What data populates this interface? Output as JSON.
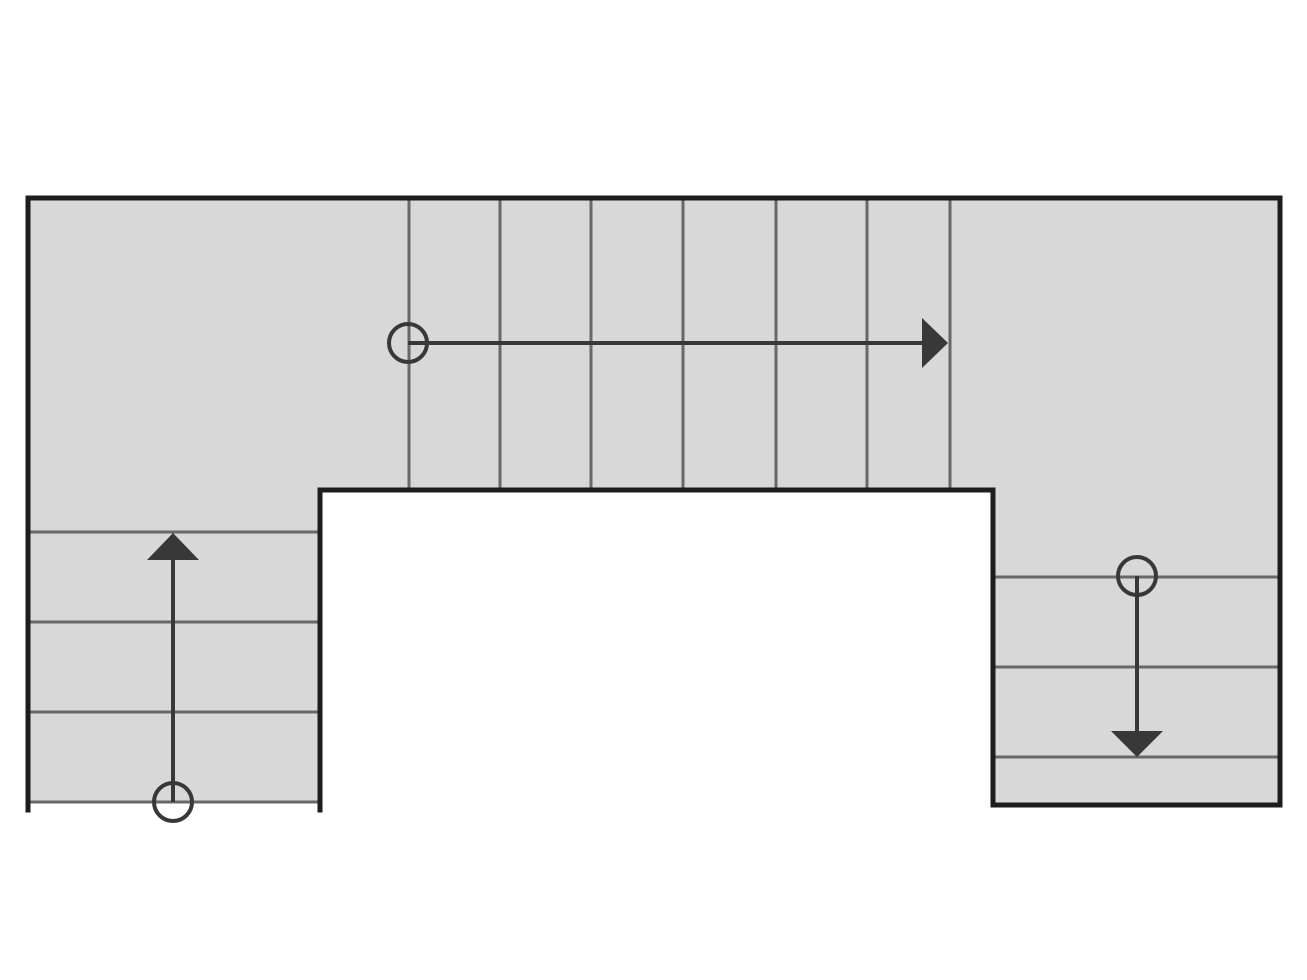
{
  "diagram": {
    "type": "stair-plan",
    "description": "U-shaped staircase floor plan with three flights and walk-line arrows",
    "canvas": {
      "width": 1307,
      "height": 980
    },
    "colors": {
      "background": "#ffffff",
      "tread_fill": "#d8d8d8",
      "outline": "#1d1d1d",
      "step_line": "#686868",
      "walk_line": "#383838"
    },
    "stroke_widths": {
      "outline": 5,
      "step_line": 3,
      "walk_line": 4,
      "circle": 4
    },
    "fill_region": {
      "points": [
        [
          28,
          198
        ],
        [
          1280,
          198
        ],
        [
          1280,
          805
        ],
        [
          993,
          805
        ],
        [
          993,
          490
        ],
        [
          320,
          490
        ],
        [
          320,
          802
        ],
        [
          28,
          802
        ]
      ]
    },
    "outline_path": {
      "points": [
        [
          28,
          810
        ],
        [
          28,
          198
        ],
        [
          1280,
          198
        ],
        [
          1280,
          805
        ],
        [
          993,
          805
        ],
        [
          993,
          490
        ],
        [
          320,
          490
        ],
        [
          320,
          810
        ]
      ]
    },
    "flights": [
      {
        "name": "upper-flight",
        "direction": "right",
        "step_lines": [
          [
            409,
            198,
            409,
            490
          ],
          [
            500,
            198,
            500,
            490
          ],
          [
            591,
            198,
            591,
            490
          ],
          [
            683,
            198,
            683,
            490
          ],
          [
            776,
            198,
            776,
            490
          ],
          [
            867,
            198,
            867,
            490
          ],
          [
            950,
            198,
            950,
            490
          ]
        ]
      },
      {
        "name": "left-flight",
        "direction": "up",
        "step_lines": [
          [
            28,
            532,
            320,
            532
          ],
          [
            28,
            622,
            320,
            622
          ],
          [
            28,
            712,
            320,
            712
          ],
          [
            28,
            802,
            320,
            802
          ]
        ]
      },
      {
        "name": "right-flight",
        "direction": "down",
        "step_lines": [
          [
            993,
            577,
            1280,
            577
          ],
          [
            993,
            667,
            1280,
            667
          ],
          [
            993,
            757,
            1280,
            757
          ]
        ]
      }
    ],
    "walk_lines": [
      {
        "name": "upper-walk-line",
        "start_circle": {
          "cx": 408,
          "cy": 343,
          "r": 19
        },
        "line": [
          408,
          343,
          924,
          343
        ],
        "arrowhead": [
          [
            922,
            318
          ],
          [
            922,
            368
          ],
          [
            948,
            343
          ]
        ]
      },
      {
        "name": "left-walk-line",
        "start_circle": {
          "cx": 173,
          "cy": 802,
          "r": 19
        },
        "line": [
          173,
          802,
          173,
          558
        ],
        "arrowhead": [
          [
            147,
            560
          ],
          [
            199,
            560
          ],
          [
            173,
            533
          ]
        ]
      },
      {
        "name": "right-walk-line",
        "start_circle": {
          "cx": 1137,
          "cy": 576,
          "r": 19
        },
        "line": [
          1137,
          576,
          1137,
          733
        ],
        "arrowhead": [
          [
            1111,
            731
          ],
          [
            1163,
            731
          ],
          [
            1137,
            757
          ]
        ]
      }
    ]
  }
}
